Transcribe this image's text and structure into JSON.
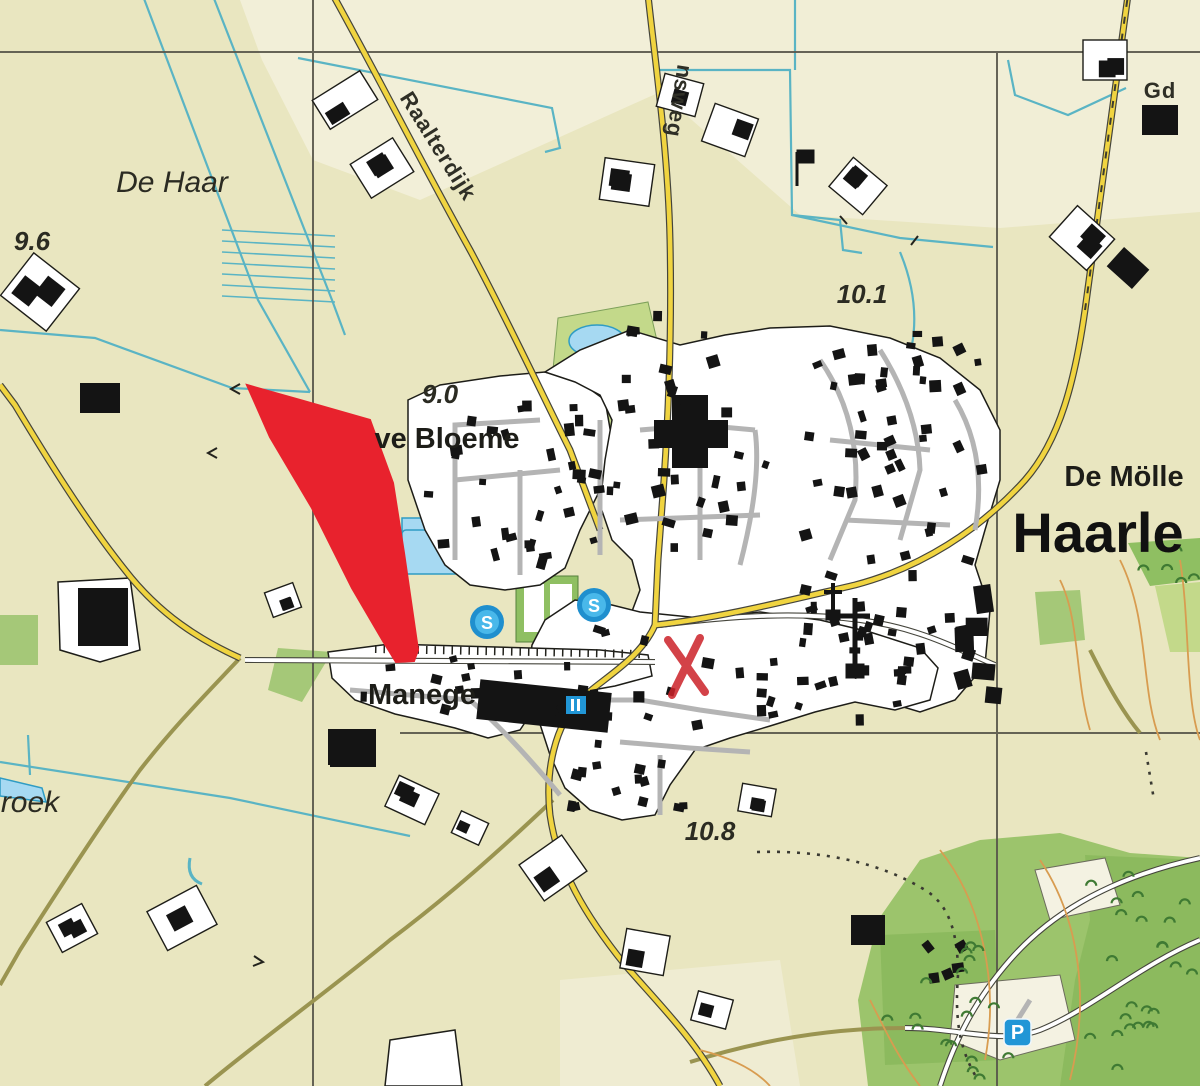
{
  "map": {
    "region_labels": {
      "de_haar": "De Haar",
      "roek": "roek",
      "de_molle": "De Mölle",
      "gd": "Gd"
    },
    "place_labels": {
      "haarle": "Haarle",
      "manege": "Manege",
      "bloeme": "ve Bloeme"
    },
    "road_labels": {
      "raalterdijk": "Raalterdijk",
      "nsweg": "nsweg"
    },
    "spot_heights": {
      "h96": "9.6",
      "h101": "10.1",
      "h90": "9.0",
      "h108": "10.8"
    },
    "icons": {
      "sports": "S",
      "parking": "P"
    },
    "colors": {
      "base": "#e9e6c0",
      "light_field": "#f2efd8",
      "road_yellow": "#f0d440",
      "road_casing": "#45453c",
      "street_gray": "#b4b4b4",
      "water": "#5ab4c4",
      "pond_fill": "#a6d9f2",
      "green_light": "#c3d98a",
      "green_mid": "#a5c878",
      "tree_green": "#3f7a33",
      "contour": "#d89c50",
      "highlight_red": "#e8222d",
      "marker_red": "#cc2229",
      "badge_blue": "#2196d6",
      "building_black": "#141414",
      "grid": "#57554a"
    },
    "building_clusters": [
      {
        "x": 415,
        "y": 400,
        "w": 185,
        "h": 170,
        "rot": 0,
        "n": 26,
        "smin": 6,
        "smax": 13
      },
      {
        "x": 560,
        "y": 345,
        "w": 210,
        "h": 210,
        "rot": 0,
        "n": 34,
        "smin": 6,
        "smax": 13
      },
      {
        "x": 790,
        "y": 335,
        "w": 200,
        "h": 180,
        "rot": -8,
        "n": 40,
        "smin": 6,
        "smax": 12
      },
      {
        "x": 800,
        "y": 520,
        "w": 180,
        "h": 170,
        "rot": 0,
        "n": 30,
        "smin": 6,
        "smax": 12
      },
      {
        "x": 545,
        "y": 625,
        "w": 370,
        "h": 105,
        "rot": 0,
        "n": 34,
        "smin": 6,
        "smax": 12
      },
      {
        "x": 560,
        "y": 735,
        "w": 130,
        "h": 80,
        "rot": 0,
        "n": 14,
        "smin": 6,
        "smax": 11
      },
      {
        "x": 345,
        "y": 655,
        "w": 180,
        "h": 60,
        "rot": 0,
        "n": 10,
        "smin": 6,
        "smax": 11
      },
      {
        "x": 905,
        "y": 925,
        "w": 70,
        "h": 60,
        "rot": -20,
        "n": 5,
        "smin": 7,
        "smax": 12
      },
      {
        "x": 620,
        "y": 300,
        "w": 90,
        "h": 40,
        "rot": 0,
        "n": 5,
        "smin": 6,
        "smax": 11
      },
      {
        "x": 948,
        "y": 555,
        "w": 58,
        "h": 150,
        "rot": 0,
        "n": 6,
        "smin": 13,
        "smax": 28
      }
    ],
    "farms": [
      {
        "x": 345,
        "y": 100,
        "w": 56,
        "h": 34,
        "rot": -32
      },
      {
        "x": 382,
        "y": 168,
        "w": 50,
        "h": 40,
        "rot": -32
      },
      {
        "x": 40,
        "y": 292,
        "w": 58,
        "h": 54,
        "rot": 38
      },
      {
        "x": 100,
        "y": 398,
        "w": 40,
        "h": 30,
        "rot": 0,
        "blackOnly": true
      },
      {
        "x": 627,
        "y": 182,
        "w": 50,
        "h": 42,
        "rot": 8
      },
      {
        "x": 730,
        "y": 130,
        "w": 46,
        "h": 40,
        "rot": 20
      },
      {
        "x": 858,
        "y": 186,
        "w": 44,
        "h": 38,
        "rot": 40
      },
      {
        "x": 1082,
        "y": 238,
        "w": 50,
        "h": 42,
        "rot": 42
      },
      {
        "x": 1128,
        "y": 268,
        "w": 34,
        "h": 26,
        "rot": 42,
        "blackOnly": true
      },
      {
        "x": 283,
        "y": 600,
        "w": 30,
        "h": 26,
        "rot": -20
      },
      {
        "x": 352,
        "y": 747,
        "w": 48,
        "h": 36,
        "rot": 0,
        "blackOnly": true
      },
      {
        "x": 412,
        "y": 800,
        "w": 44,
        "h": 34,
        "rot": 25
      },
      {
        "x": 553,
        "y": 868,
        "w": 52,
        "h": 44,
        "rot": -35
      },
      {
        "x": 182,
        "y": 918,
        "w": 56,
        "h": 44,
        "rot": -28
      },
      {
        "x": 72,
        "y": 928,
        "w": 40,
        "h": 34,
        "rot": -28
      },
      {
        "x": 645,
        "y": 952,
        "w": 44,
        "h": 40,
        "rot": 10
      },
      {
        "x": 712,
        "y": 1010,
        "w": 36,
        "h": 30,
        "rot": 15
      },
      {
        "x": 470,
        "y": 828,
        "w": 30,
        "h": 24,
        "rot": 25
      },
      {
        "x": 868,
        "y": 930,
        "w": 34,
        "h": 30,
        "rot": 0,
        "blackOnly": true
      },
      {
        "x": 757,
        "y": 800,
        "w": 34,
        "h": 28,
        "rot": 10
      },
      {
        "x": 680,
        "y": 95,
        "w": 40,
        "h": 34,
        "rot": 15
      },
      {
        "x": 1105,
        "y": 60,
        "w": 44,
        "h": 40,
        "rot": 0
      },
      {
        "x": 1160,
        "y": 120,
        "w": 36,
        "h": 30,
        "rot": 0,
        "blackOnly": true
      }
    ],
    "tree_areas": [
      {
        "x": 1090,
        "y": 860,
        "w": 105,
        "h": 215,
        "n": 24
      },
      {
        "x": 885,
        "y": 940,
        "w": 110,
        "h": 120,
        "n": 12
      },
      {
        "x": 1132,
        "y": 548,
        "w": 62,
        "h": 34,
        "n": 5
      },
      {
        "x": 940,
        "y": 1040,
        "w": 80,
        "h": 42,
        "n": 6
      }
    ]
  }
}
